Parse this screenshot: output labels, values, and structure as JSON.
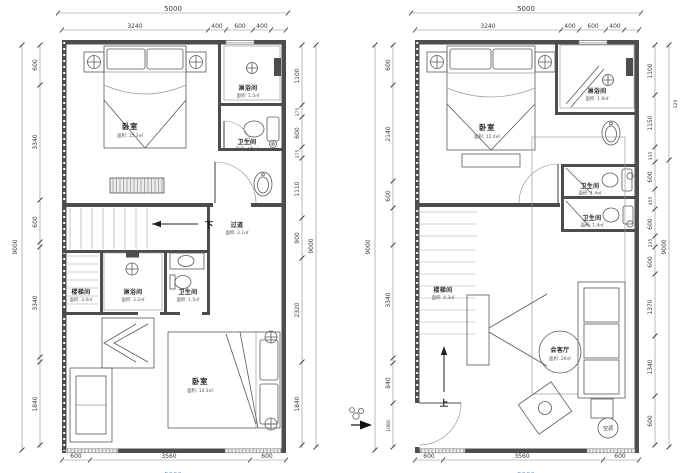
{
  "doc": {
    "title_hidden": ""
  },
  "left_plan": {
    "top_total": "5000",
    "top_segments": [
      "3240",
      "400",
      "600",
      "400"
    ],
    "side_outer_left": "9000",
    "left_segments": [
      "600",
      "3340",
      "600",
      "3340",
      "1840"
    ],
    "right_segments": [
      "1100",
      "175",
      "600",
      "175",
      "1110",
      "900",
      "2320",
      "1840"
    ],
    "side_outer_right": "9000",
    "bottom_segments": [
      "600",
      "3560",
      "600"
    ],
    "bottom_total": "5000",
    "stair_direction": "下",
    "rooms": {
      "bedroom_upper": {
        "label": "卧室",
        "area": "面积: 15.3㎡"
      },
      "shower_upper": {
        "label": "淋浴间",
        "area": "面积: 1.5㎡"
      },
      "bath_upper": {
        "label": "卫生间",
        "area": "面积: 1.5㎡"
      },
      "corridor": {
        "label": "过道",
        "area": "面积: 2.1㎡"
      },
      "stairwell": {
        "label": "楼梯间",
        "area": "面积: 3.0㎡"
      },
      "shower_lower": {
        "label": "淋浴间",
        "area": "面积: 2.2㎡"
      },
      "bath_lower": {
        "label": "卫生间",
        "area": "面积: 1.5㎡"
      },
      "bedroom_lower": {
        "label": "卧室",
        "area": "面积: 14.3㎡"
      }
    }
  },
  "right_plan": {
    "top_total": "5000",
    "top_segments": [
      "3240",
      "400",
      "600",
      "400"
    ],
    "side_outer_left": "9000",
    "left_segments": [
      "600",
      "2140",
      "600",
      "3340",
      "840",
      "1080"
    ],
    "right_segments": [
      "1100",
      "1150",
      "335",
      "600",
      "455",
      "600",
      "235",
      "600",
      "1370",
      "1340",
      "600"
    ],
    "side_outer_right": "9000",
    "side_outer_small": "120",
    "bottom_segments": [
      "600",
      "3560",
      "600"
    ],
    "bottom_total": "5000",
    "stair_direction": "上",
    "rooms": {
      "bedroom": {
        "label": "卧室",
        "area": "面积: 12.4㎡"
      },
      "shower": {
        "label": "淋浴间",
        "area": "面积: 1.9㎡"
      },
      "bath_upper": {
        "label": "卫生间",
        "area": "面积: 1.4㎡"
      },
      "bath_lower": {
        "label": "卫生间",
        "area": "面积: 1.4㎡"
      },
      "stairwell": {
        "label": "楼梯间",
        "area": "面积: 4.3㎡"
      },
      "living": {
        "label": "会客厅",
        "area": "面积: 20㎡"
      },
      "ac": {
        "label": "空调"
      }
    }
  }
}
